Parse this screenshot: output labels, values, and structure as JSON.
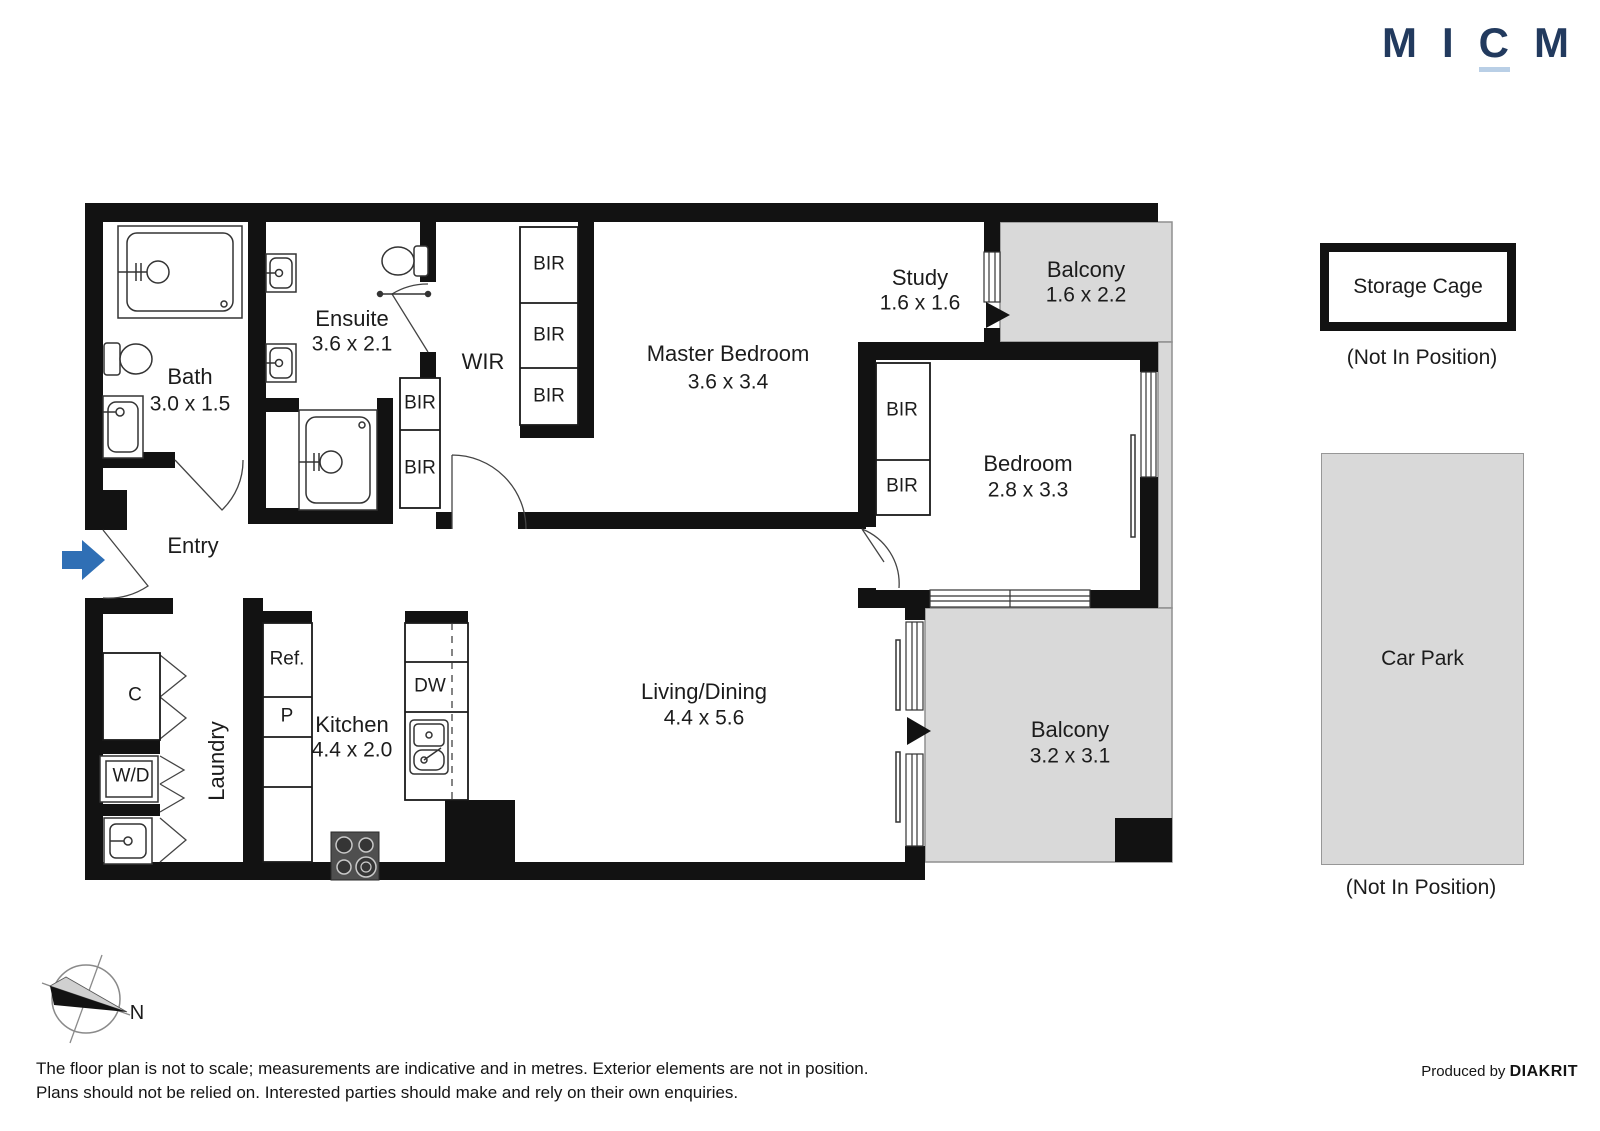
{
  "logo": {
    "letters": [
      "M",
      "I",
      "C",
      "M"
    ],
    "color": "#223a5e",
    "underline_color": "#b9cfe6"
  },
  "rooms": [
    {
      "name": "Bath",
      "dims": "3.0 x 1.5"
    },
    {
      "name": "Ensuite",
      "dims": "3.6 x 2.1"
    },
    {
      "name": "WIR",
      "dims": ""
    },
    {
      "name": "Master Bedroom",
      "dims": "3.6 x 3.4"
    },
    {
      "name": "Study",
      "dims": "1.6 x 1.6"
    },
    {
      "name": "Balcony",
      "dims": "1.6 x 2.2"
    },
    {
      "name": "Bedroom",
      "dims": "2.8 x 3.3"
    },
    {
      "name": "Entry",
      "dims": ""
    },
    {
      "name": "Laundry",
      "dims": ""
    },
    {
      "name": "Kitchen",
      "dims": "4.4 x 2.0"
    },
    {
      "name": "Living/Dining",
      "dims": "4.4 x 5.6"
    },
    {
      "name": "Balcony",
      "dims": "3.2 x 3.1"
    }
  ],
  "labels": {
    "bir": "BIR",
    "closet": "C",
    "washer_dryer": "W/D",
    "fridge": "Ref.",
    "pantry": "P",
    "oven": "Ovn",
    "dishwasher": "DW"
  },
  "storage_cage": {
    "label": "Storage Cage",
    "note": "(Not In Position)"
  },
  "car_park": {
    "label": "Car Park",
    "note": "(Not In Position)"
  },
  "compass": {
    "north_label": "N"
  },
  "footer": {
    "disclaimer_line1": "The floor plan is not to scale; measurements are indicative and in metres. Exterior elements are not in position.",
    "disclaimer_line2": "Plans should not be relied on. Interested parties should make and rely on their own enquiries.",
    "produced_by": "Produced by",
    "brand": "DIAKRIT"
  },
  "colors": {
    "wall": "#121212",
    "balcony_fill": "#d9d9d9",
    "entry_arrow": "#2f6fb5"
  }
}
